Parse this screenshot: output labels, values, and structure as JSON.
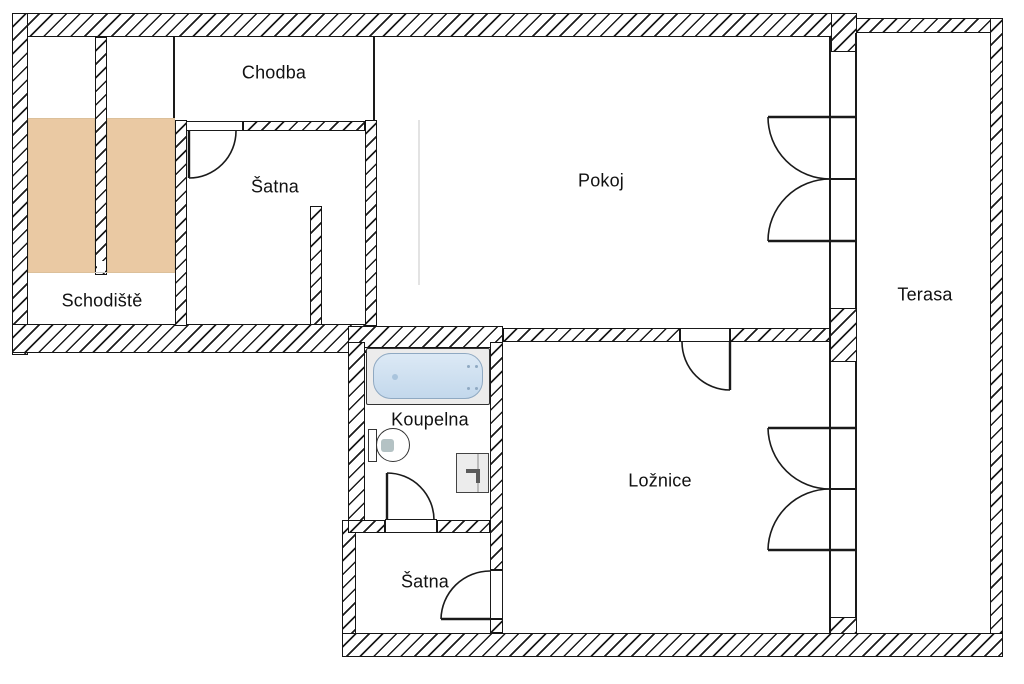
{
  "rooms": {
    "chodba": {
      "label": "Chodba"
    },
    "satna_upper": {
      "label": "Šatna"
    },
    "pokoj": {
      "label": "Pokoj"
    },
    "schodiste": {
      "label": "Schodiště"
    },
    "terasa": {
      "label": "Terasa"
    },
    "koupelna": {
      "label": "Koupelna"
    },
    "loznice": {
      "label": "Ložnice"
    },
    "satna_lower": {
      "label": "Šatna"
    }
  },
  "fixtures": {
    "bathtub": "bathtub",
    "toilet": "toilet",
    "sink": "sink",
    "stairs": "staircase-flights"
  },
  "colors": {
    "background": "#ffffff",
    "wall_outline": "#1a1a1a",
    "hatch_line": "#1c1c1c",
    "stair_fill": "#eac9a3",
    "bathtub_fill": "#cfe0ef"
  }
}
